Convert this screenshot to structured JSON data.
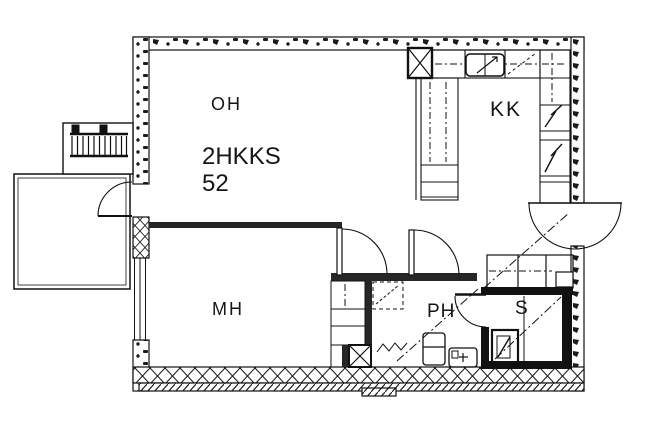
{
  "page": {
    "background": "#ffffff",
    "ink": "#161616",
    "wall_dark": "#111111",
    "wall_mid": "#262626"
  },
  "plan": {
    "apartment_type": "2HKKS",
    "area_m2": "52",
    "rooms": [
      {
        "id": "oh",
        "label": "OH",
        "name": "living-room"
      },
      {
        "id": "kk",
        "label": "KK",
        "name": "kitchenette"
      },
      {
        "id": "mh",
        "label": "MH",
        "name": "bedroom"
      },
      {
        "id": "ph",
        "label": "PH",
        "name": "bathroom"
      },
      {
        "id": "s",
        "label": "S",
        "name": "sauna"
      }
    ],
    "fixtures": [
      "kitchen-sink",
      "refrigerator-cabinets",
      "ventilation-duct-kitchen",
      "ventilation-duct-bathroom",
      "washing-machine",
      "wc-basin",
      "shower-area",
      "sauna-heater",
      "hall-wardrobes",
      "bedroom-closets",
      "balcony",
      "entrance-stairs",
      "entry-door",
      "balcony-door",
      "bathroom-door",
      "sauna-door",
      "room-doors"
    ]
  }
}
